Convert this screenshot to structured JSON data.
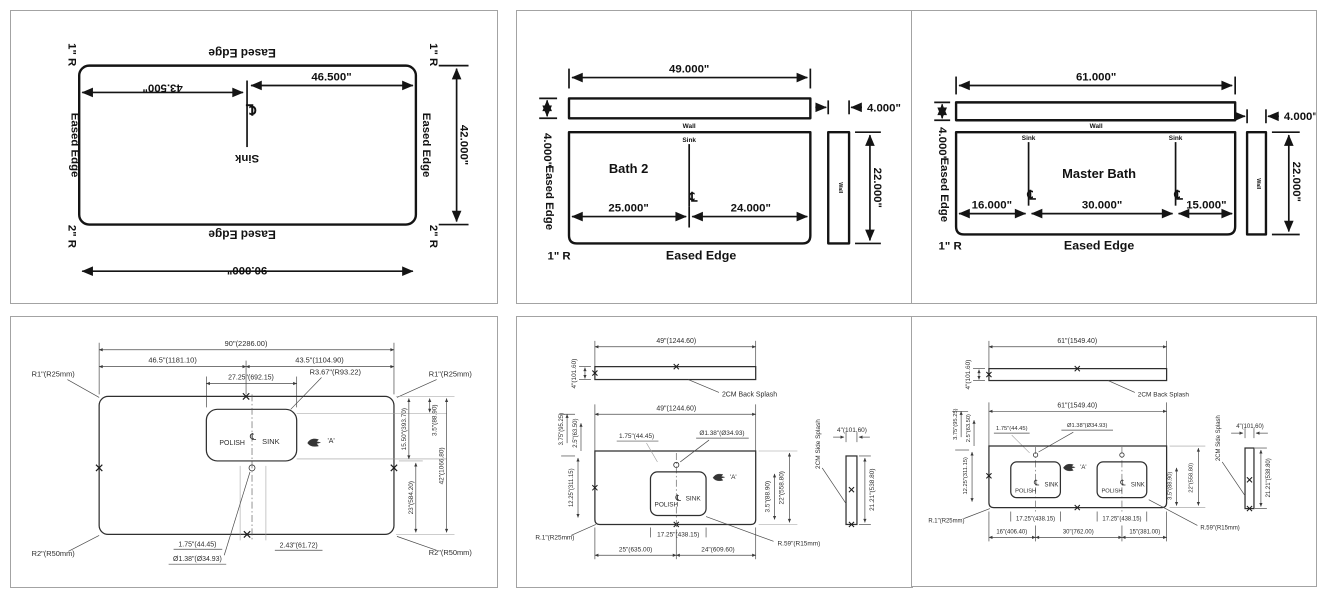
{
  "common": {
    "eased_edge": "Eased Edge",
    "wall": "Wall",
    "sink_label": "Sink",
    "sink_caps": "SINK",
    "polish": "POLISH",
    "centerline_symbol": "℄",
    "detail_a": "'A'",
    "radius_1": "1\" R",
    "radius_2": "2\" R",
    "back_splash_label": "2CM Back Splash",
    "side_splash_label": "2CM Side Splash"
  },
  "island_plan": {
    "length": "90.000\"",
    "depth": "42.000\"",
    "sink_from_left": "43.500\"",
    "sink_from_right": "46.500\""
  },
  "bath2_plan": {
    "room": "Bath 2",
    "length": "49.000\"",
    "splash_height": "4.000\"",
    "side_splash_width": "4.000\"",
    "depth": "22.000\"",
    "sink_from_left": "25.000\"",
    "sink_from_right": "24.000\""
  },
  "master_plan": {
    "room": "Master Bath",
    "length": "61.000\"",
    "splash_height": "4.000\"",
    "side_splash_width": "4.000\"",
    "depth": "22.000\"",
    "sink1_from_left": "16.000\"",
    "sink_spacing": "30.000\"",
    "sink2_from_right": "15.000\""
  },
  "island_cad": {
    "length": "90\"(2286.00)",
    "left_half": "46.5\"(1181.10)",
    "right_half": "43.5\"(1104.90)",
    "sink_width": "27.25\"(692.15)",
    "sink_corner_radius": "R3.67\"(R93.22)",
    "corner_radius_top": "R1\"(R25mm)",
    "corner_radius_bottom": "R2\"(R50mm)",
    "sink_span": "15.50\"(393.70)",
    "sink_top_offset": "3.5\"(88.90)",
    "sink_to_bottom": "23\"(584.20)",
    "depth": "42\"(1066.80)",
    "hole_offset": "1.75\"(44.45)",
    "hole_diameter": "Ø1.38\"(Ø34.93)",
    "hole_offset_2": "2.43\"(61.72)"
  },
  "bath2_cad": {
    "splash_length": "49\"(1244.60)",
    "length": "49\"(1244.60)",
    "splash_height": "4\"(101.60)",
    "back_offset": "3.75\"(95.25)",
    "back_offset_2": "2.5\"(63.50)",
    "sink_center_depth": "12.25\"(311.15)",
    "hole_offset": "1.75\"(44.45)",
    "hole_diameter": "Ø1.38\"(Ø34.93)",
    "sink_to_bottom": "3.5\"(88.90)",
    "depth": "22\"(558.80)",
    "corner_radius": "R.1\"(R25mm)",
    "sink_width": "17.25\"(438.15)",
    "sink_corner_radius": "R.59\"(R15mm)",
    "sink_from_left": "25\"(635.00)",
    "sink_from_right": "24\"(609.60)",
    "side_splash_width": "4\"(101.60)",
    "side_splash_length": "21.21\"(538.80)"
  },
  "master_cad": {
    "splash_length": "61\"(1549.40)",
    "length": "61\"(1549.40)",
    "splash_height": "4\"(101.60)",
    "back_offset": "3.75\"(95.25)",
    "back_offset_2": "2.5\"(63.50)",
    "sink_center_depth": "12.25\"(311.15)",
    "hole_offset": "1.75\"(44.45)",
    "hole_diameter": "Ø1.38\"(Ø34.93)",
    "sink_to_bottom": "3.5\"(88.90)",
    "depth": "22\"(558.80)",
    "corner_radius": "R.1\"(R25mm)",
    "sink1_width": "17.25\"(438.15)",
    "sink2_width": "17.25\"(438.15)",
    "sink_corner_radius": "R.59\"(R15mm)",
    "sink1_from_left": "16\"(406.40)",
    "sink_spacing": "30\"(762.00)",
    "sink2_from_right": "15\"(381.00)",
    "side_splash_width": "4\"(101.60)",
    "side_splash_length": "21.21\"(538.80)"
  }
}
